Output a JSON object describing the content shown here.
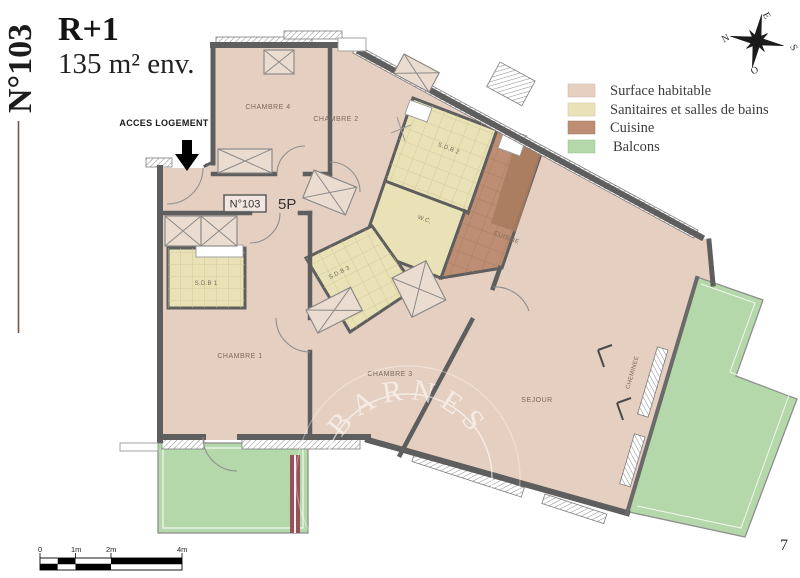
{
  "title": {
    "unit_vertical": "N°103",
    "floor": "R+1",
    "area": "135 m² env."
  },
  "entrance": {
    "label": "ACCES LOGEMENT"
  },
  "unit_box": {
    "number": "N°103",
    "rooms": "5P"
  },
  "legend": {
    "items": [
      {
        "label": "Surface habitable",
        "color": "#e5cfc0"
      },
      {
        "label": "Sanitaires et salles de bains",
        "color": "#e9e2b7"
      },
      {
        "label": "Cuisine",
        "color": "#bd8e73"
      },
      {
        "label": "Balcons",
        "color": "#b4d8a9"
      }
    ]
  },
  "compass": {
    "n": "N",
    "e": "E",
    "s": "S",
    "o": "O"
  },
  "rooms": {
    "chambre1": "CHAMBRE 1",
    "chambre2": "CHAMBRE 2",
    "chambre3": "CHAMBRE 3",
    "chambre4": "CHAMBRE 4",
    "sdb1": "S.D.B 1",
    "sdb2": "S.D.B 2",
    "sdb3": "S.D.B 3",
    "wc": "W.C.",
    "cuisine": "CUISINE",
    "sejour": "SEJOUR",
    "cheminee": "CHEMINEE"
  },
  "scale_bar": {
    "labels": [
      "0",
      "1m",
      "2m",
      "4m"
    ]
  },
  "watermark": {
    "brand": "BARNES",
    "initial": "B"
  },
  "page_number": "7",
  "colors": {
    "accent_line": "#7d5548",
    "wall": "#5e5e5e",
    "railing_maroon": "#96525a"
  }
}
